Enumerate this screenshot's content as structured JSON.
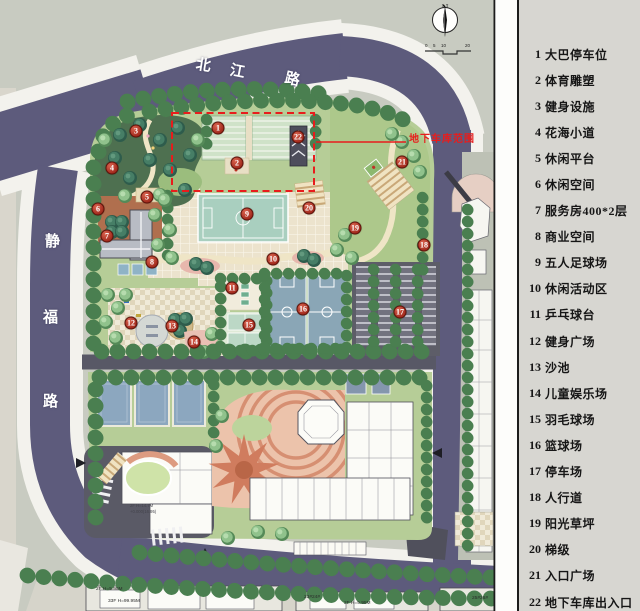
{
  "legend": {
    "items": [
      {
        "num": "1",
        "label": "大巴停车位"
      },
      {
        "num": "2",
        "label": "体育雕塑"
      },
      {
        "num": "3",
        "label": "健身设施"
      },
      {
        "num": "4",
        "label": "花海小道"
      },
      {
        "num": "5",
        "label": "休闲平台"
      },
      {
        "num": "6",
        "label": "休闲空间"
      },
      {
        "num": "7",
        "label": "服务房400*2层"
      },
      {
        "num": "8",
        "label": "商业空间"
      },
      {
        "num": "9",
        "label": "五人足球场"
      },
      {
        "num": "10",
        "label": "休闲活动区"
      },
      {
        "num": "11",
        "label": "乒乓球台"
      },
      {
        "num": "12",
        "label": "健身广场"
      },
      {
        "num": "13",
        "label": "沙池"
      },
      {
        "num": "14",
        "label": "儿童娱乐场"
      },
      {
        "num": "15",
        "label": "羽毛球场"
      },
      {
        "num": "16",
        "label": "篮球场"
      },
      {
        "num": "17",
        "label": "停车场"
      },
      {
        "num": "18",
        "label": "人行道"
      },
      {
        "num": "19",
        "label": "阳光草坪"
      },
      {
        "num": "20",
        "label": "梯级"
      },
      {
        "num": "21",
        "label": "入口广场"
      },
      {
        "num": "22",
        "label": "地下车库出入口"
      }
    ]
  },
  "roads": {
    "top": {
      "name": "北江路",
      "chars": [
        "北",
        "江",
        "路"
      ]
    },
    "left": {
      "name": "静福路",
      "chars": [
        "静",
        "福",
        "路"
      ]
    }
  },
  "annotations": {
    "garage_range": "地下车库范围",
    "bldg_left_1": "2F H=5.95M",
    "bldg_left_2": "33F H=99.95M",
    "bldg_right_1": "23#24#",
    "bldg_right_2": "2F H=5.95M",
    "bldg_corner": "25#26#",
    "center_1": "2F H=14.7M",
    "center_2": "+0.000(16.95)"
  },
  "compass": {
    "label": "N"
  },
  "scale_bar": {
    "ticks": [
      "0",
      "5",
      "10",
      "20"
    ]
  },
  "markers": [
    {
      "num": "1",
      "x": 218,
      "y": 128
    },
    {
      "num": "2",
      "x": 237,
      "y": 163
    },
    {
      "num": "3",
      "x": 136,
      "y": 131
    },
    {
      "num": "4",
      "x": 112,
      "y": 168
    },
    {
      "num": "5",
      "x": 147,
      "y": 197
    },
    {
      "num": "6",
      "x": 98,
      "y": 209
    },
    {
      "num": "7",
      "x": 107,
      "y": 236
    },
    {
      "num": "8",
      "x": 152,
      "y": 262
    },
    {
      "num": "9",
      "x": 247,
      "y": 214
    },
    {
      "num": "10",
      "x": 273,
      "y": 259
    },
    {
      "num": "11",
      "x": 232,
      "y": 288
    },
    {
      "num": "12",
      "x": 131,
      "y": 323
    },
    {
      "num": "13",
      "x": 172,
      "y": 326
    },
    {
      "num": "14",
      "x": 194,
      "y": 342
    },
    {
      "num": "15",
      "x": 249,
      "y": 325
    },
    {
      "num": "16",
      "x": 303,
      "y": 309
    },
    {
      "num": "17",
      "x": 400,
      "y": 312
    },
    {
      "num": "18",
      "x": 424,
      "y": 245
    },
    {
      "num": "19",
      "x": 355,
      "y": 228
    },
    {
      "num": "20",
      "x": 309,
      "y": 208
    },
    {
      "num": "21",
      "x": 402,
      "y": 162
    },
    {
      "num": "22",
      "x": 298,
      "y": 137
    }
  ],
  "colors": {
    "road": "#5d5b7c",
    "lawn": "#b6cd97",
    "tree": "#92c48e",
    "marker_red": "#a22a1d",
    "garage_outline": "#e81c1c",
    "court_blue": "#8aa6b6",
    "field_teal": "#a9cfbf"
  }
}
